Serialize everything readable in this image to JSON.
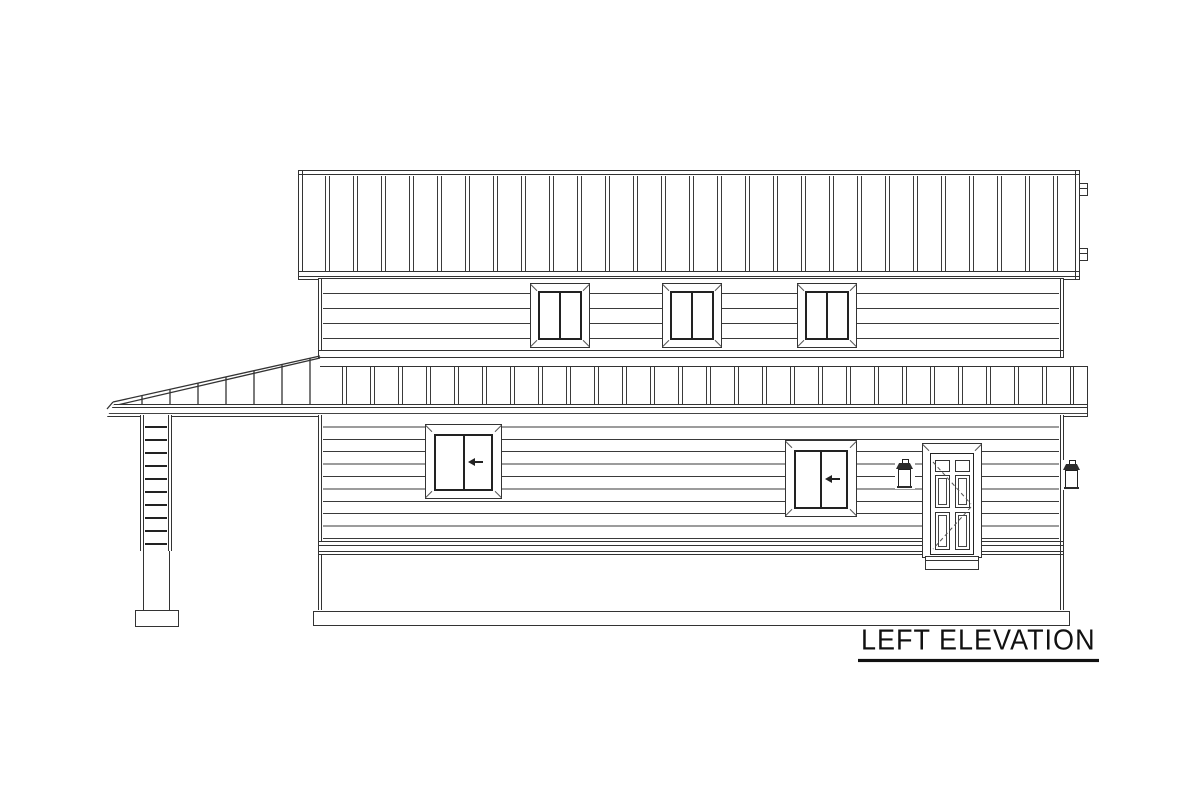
{
  "title": {
    "label": "LEFT ELEVATION"
  },
  "colors": {
    "line": "#333333",
    "background": "#ffffff"
  },
  "elevation": {
    "view": "left side of two-story house",
    "upper_roof_band": "standing-seam vertical battens",
    "mid_roof_band": "standing-seam pent roof with left porch slope",
    "second_story_windows": {
      "count": 3,
      "panes_each": 2
    },
    "first_story_windows": {
      "count": 2,
      "panes_each": 2,
      "slider_arrow_direction": "left"
    },
    "door": {
      "panels": 6,
      "swing_indicator": "dashed",
      "step_below": true
    },
    "lanterns": {
      "count": 2
    },
    "porch_posts": {
      "count": 1
    },
    "foundation": "continuous footing line"
  }
}
